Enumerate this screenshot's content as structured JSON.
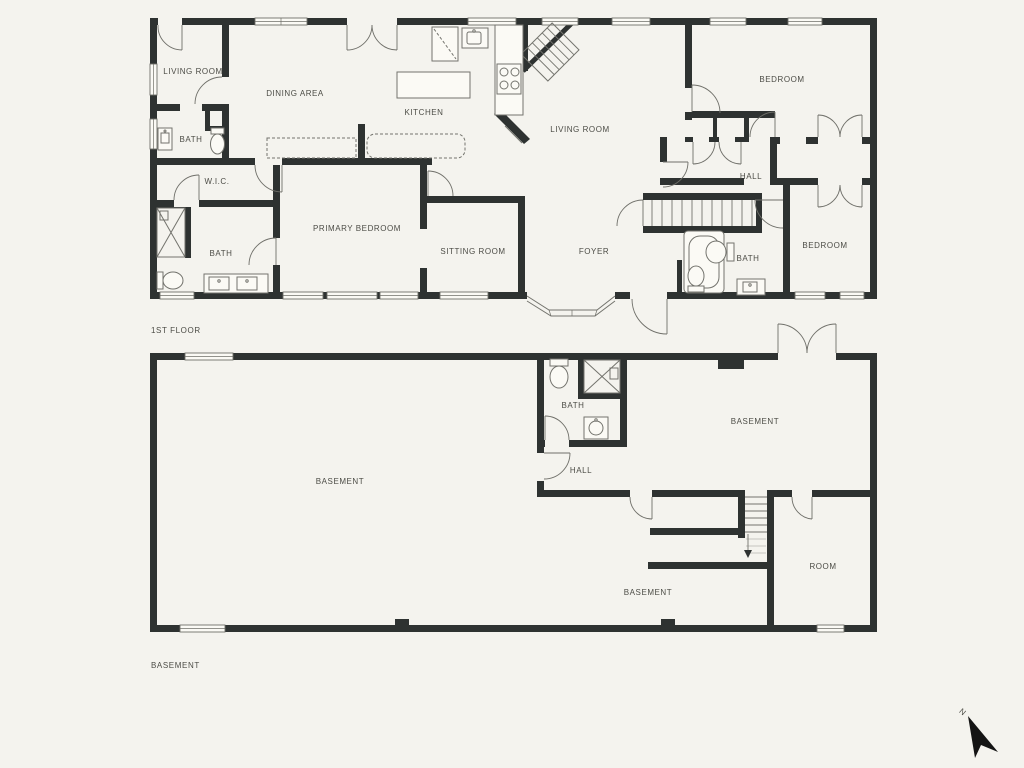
{
  "colors": {
    "background": "#f4f3ee",
    "wall": "#2e3231",
    "window_fill": "#fbfaf5",
    "thin_line": "#6f6f69",
    "fixture_line": "#73736d",
    "label_text": "#4c4c46",
    "compass": "#141414"
  },
  "first_floor": {
    "floor_label": "1ST FLOOR",
    "rooms": {
      "living_room_small": "LIVING ROOM",
      "bath_upper_left": "BATH",
      "dining_area": "DINING AREA",
      "kitchen": "KITCHEN",
      "living_room_main": "LIVING ROOM",
      "bedroom_top_right": "BEDROOM",
      "hall": "HALL",
      "wic": "W.I.C.",
      "bath_left": "BATH",
      "primary_bedroom": "PRIMARY BEDROOM",
      "sitting_room": "SITTING ROOM",
      "foyer": "FOYER",
      "bath_right": "BATH",
      "bedroom_right": "BEDROOM"
    }
  },
  "basement": {
    "floor_label": "BASEMENT",
    "rooms": {
      "bath": "BATH",
      "basement_right": "BASEMENT",
      "hall": "HALL",
      "basement_main": "BASEMENT",
      "basement_lower": "BASEMENT",
      "room": "ROOM"
    }
  },
  "compass": {
    "north_label": "N"
  }
}
